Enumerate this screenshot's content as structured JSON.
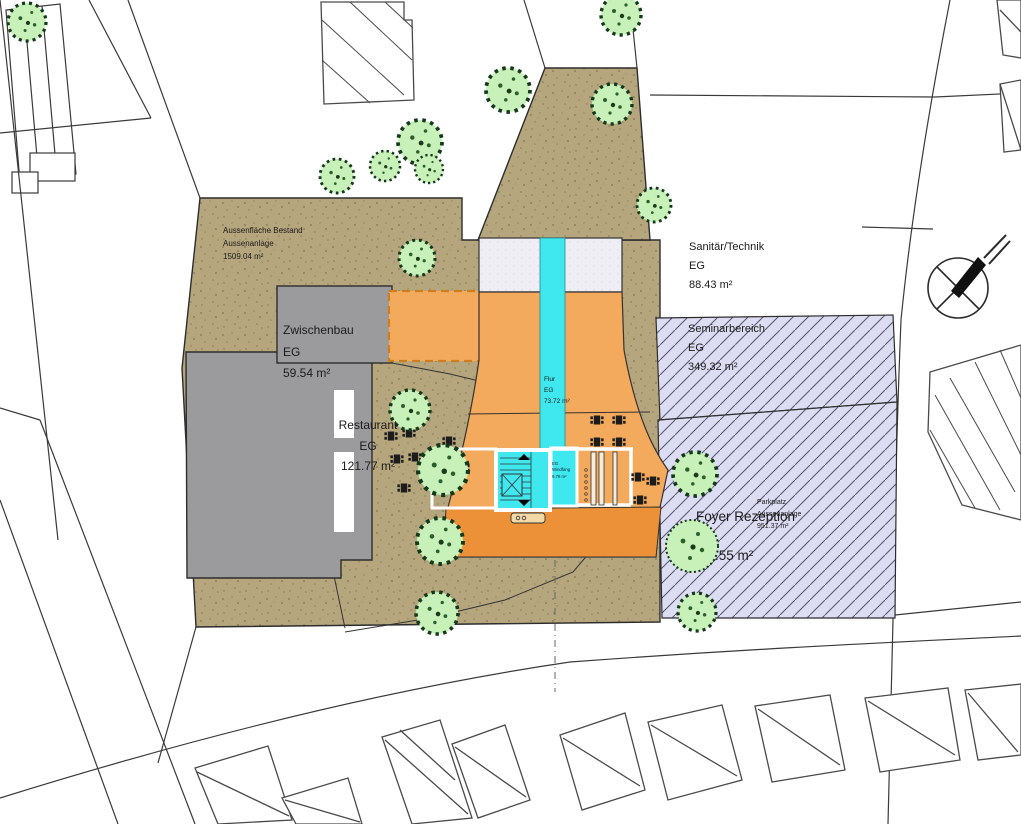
{
  "areas": {
    "aussenflaeche": {
      "line1": "Aussenfläche Bestand",
      "line2": "Aussenanlage",
      "area": "1509.04 m²"
    },
    "zwischenbau": {
      "name": "Zwischenbau",
      "floor": "EG",
      "area": "59.54 m²"
    },
    "restaurant": {
      "name": "Restaurant",
      "floor": "EG",
      "area": "121.77 m²"
    },
    "sanitaer_technik": {
      "name": "Sanitär/Technik",
      "floor": "EG",
      "area": "88.43 m²"
    },
    "seminarbereich": {
      "name": "Seminarbereich",
      "floor": "EG",
      "area": "349.32 m²"
    },
    "foyer": {
      "name": "Foyer Rezeption",
      "area": "49.55 m²"
    },
    "parkplatz": {
      "line1": "Parkplatz",
      "line2": "Aussenanlage",
      "area": "951.37 m²"
    },
    "flur": {
      "name": "Flur",
      "floor": "EG",
      "area": "73.72 m²"
    },
    "windfang": {
      "floor": "EG",
      "name": "Windfang",
      "area": "9.78 m²"
    }
  },
  "colors": {
    "site_tan": "#b6a67e",
    "building_orange": "#f3aa5c",
    "building_orange_dark": "#ec9138",
    "corridor_cyan": "#3ee8ee",
    "seminar_lavender": "#dcdcf2",
    "existing_gray": "#9b9b9e",
    "tree_green": "#c8f1ba",
    "linework": "#2d2d2d"
  },
  "icons": {
    "north_arrow": "north-arrow",
    "tree": "tree",
    "table_seating": "table-with-chairs",
    "stairs": "stairs",
    "elevator": "elevator",
    "bench": "bench"
  }
}
